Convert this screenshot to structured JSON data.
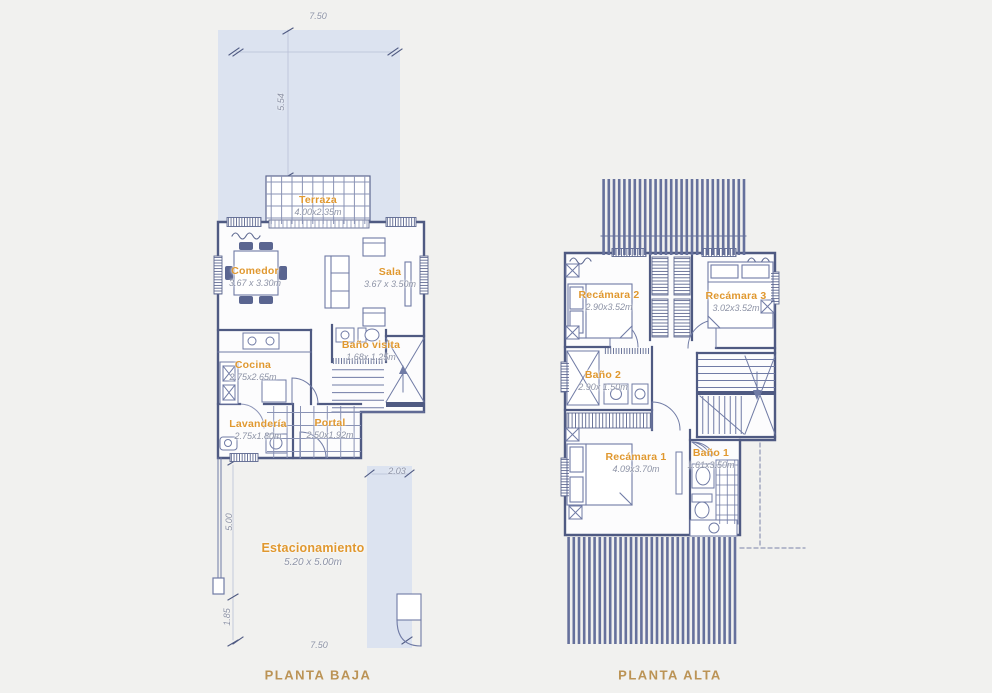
{
  "document_type": "architectural-floor-plan",
  "colors": {
    "background": "#f1f1ef",
    "yard_fill": "#dce3f0",
    "wall": "#4f5a82",
    "thin_line": "#707ba5",
    "hatch": "#66719c",
    "room_label": "#e0982f",
    "dimension_text": "#8d93a6",
    "title_text": "#bb9355"
  },
  "plans": [
    {
      "id": "planta-baja",
      "title": "PLANTA BAJA",
      "rooms": [
        {
          "name": "Terraza",
          "dims": "4.00x2.35m"
        },
        {
          "name": "Comedor",
          "dims": "3.67 x 3.30m"
        },
        {
          "name": "Sala",
          "dims": "3.67 x 3.50m"
        },
        {
          "name": "Cocina",
          "dims": "2.75x2.65m"
        },
        {
          "name": "Baño visita",
          "dims": "1.68x 1.25m"
        },
        {
          "name": "Lavandería",
          "dims": "2.75x1.80m"
        },
        {
          "name": "Portal",
          "dims": "2.50x1.92m"
        },
        {
          "name": "Estacionamiento",
          "dims": "5.20 x 5.00m"
        }
      ],
      "measurements": {
        "top": "7.50",
        "side_upper": "5.54",
        "driveway": "2.03",
        "parking_depth": "5.00",
        "setback": "1.85",
        "bottom": "7.50"
      }
    },
    {
      "id": "planta-alta",
      "title": "PLANTA ALTA",
      "rooms": [
        {
          "name": "Recámara 2",
          "dims": "2.90x3.52m"
        },
        {
          "name": "Recámara 3",
          "dims": "3.02x3.52m"
        },
        {
          "name": "Baño 2",
          "dims": "2.90x 1.50m"
        },
        {
          "name": "Recámara 1",
          "dims": "4.09x3.70m"
        },
        {
          "name": "Baño 1",
          "dims": "1.61x3.50m"
        }
      ]
    }
  ]
}
